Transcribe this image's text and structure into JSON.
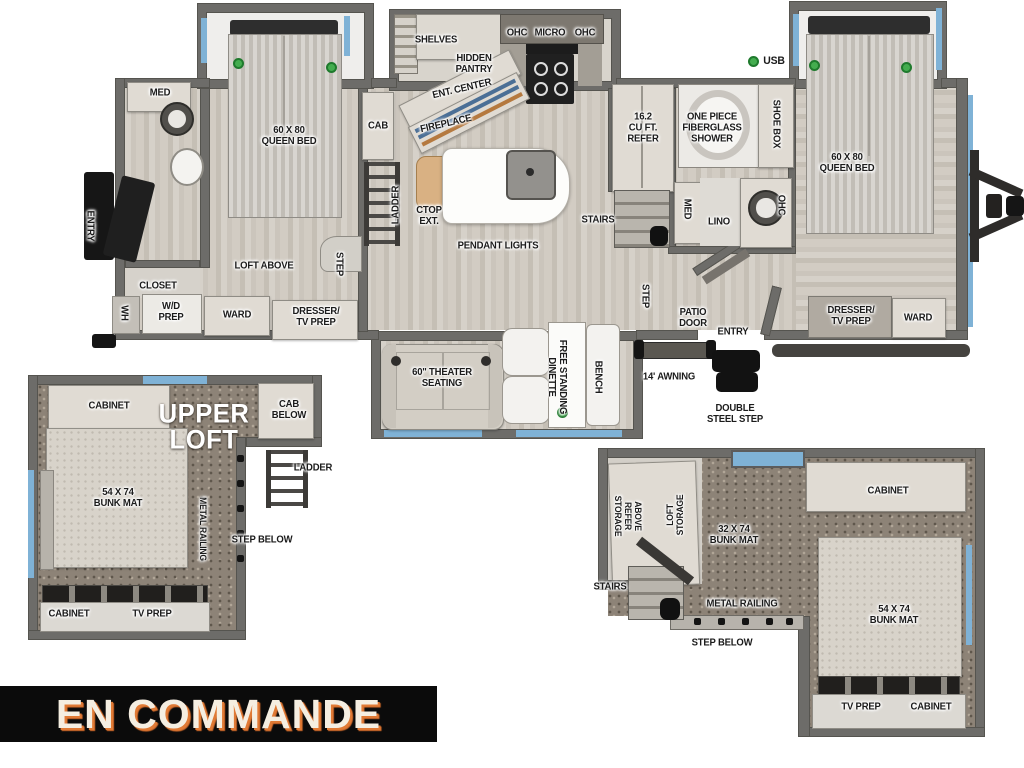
{
  "banner": {
    "label": "EN COMMANDE"
  },
  "colors": {
    "wall": "#6d6c69",
    "floor_light": "#d6d1c9",
    "floor_dark": "#c5bfb5",
    "carpet": "#8d8377",
    "furniture": "#e0dbd3",
    "accent_blue": "#7fb2d6",
    "indicator_green": "#44ad4f",
    "banner_bg": "#0b0b0b",
    "banner_text": "#f5eee1",
    "banner_shadow": "#e07a35"
  },
  "regions": {
    "main_floorplan": {
      "name": "main-floorplan",
      "labels": [
        {
          "t": "MED",
          "x": 160,
          "y": 93
        },
        {
          "t": "ENTRY",
          "x": 90,
          "y": 226,
          "r": 90
        },
        {
          "t": "CLOSET",
          "x": 158,
          "y": 286
        },
        {
          "t": "WH",
          "x": 124,
          "y": 313,
          "r": 90
        },
        {
          "t": "W/D\nPREP",
          "x": 171,
          "y": 312
        },
        {
          "t": "60 X 80\nQUEEN BED",
          "x": 289,
          "y": 136
        },
        {
          "t": "LOFT ABOVE",
          "x": 264,
          "y": 266
        },
        {
          "t": "WARD",
          "x": 237,
          "y": 315
        },
        {
          "t": "DRESSER/\nTV PREP",
          "x": 316,
          "y": 317
        },
        {
          "t": "STEP",
          "x": 339,
          "y": 264,
          "r": 90
        },
        {
          "t": "CAB",
          "x": 378,
          "y": 126
        },
        {
          "t": "LADDER",
          "x": 396,
          "y": 205,
          "r": -90
        },
        {
          "t": "SHELVES",
          "x": 436,
          "y": 40
        },
        {
          "t": "HIDDEN\nPANTRY",
          "x": 474,
          "y": 64
        },
        {
          "t": "ENT. CENTER",
          "x": 462,
          "y": 89,
          "r": -13
        },
        {
          "t": "FIREPLACE",
          "x": 446,
          "y": 124,
          "r": -13
        },
        {
          "t": "OHC",
          "x": 517,
          "y": 33
        },
        {
          "t": "MICRO",
          "x": 550,
          "y": 33
        },
        {
          "t": "OHC",
          "x": 585,
          "y": 33
        },
        {
          "t": "CTOP\nEXT.",
          "x": 429,
          "y": 216
        },
        {
          "t": "PENDANT LIGHTS",
          "x": 498,
          "y": 246
        },
        {
          "t": "STAIRS",
          "x": 598,
          "y": 220
        },
        {
          "t": "16.2\nCU FT.\nREFER",
          "x": 643,
          "y": 128
        },
        {
          "t": "USB",
          "x": 774,
          "y": 61,
          "fs": 11
        },
        {
          "t": "ONE PIECE\nFIBERGLASS\nSHOWER",
          "x": 712,
          "y": 128
        },
        {
          "t": "SHOE BOX",
          "x": 776,
          "y": 124,
          "r": 90
        },
        {
          "t": "MED",
          "x": 687,
          "y": 209,
          "r": 90
        },
        {
          "t": "LINO",
          "x": 719,
          "y": 222
        },
        {
          "t": "OHC",
          "x": 781,
          "y": 205,
          "r": 90
        },
        {
          "t": "STEP",
          "x": 645,
          "y": 296,
          "r": 90
        },
        {
          "t": "PATIO\nDOOR",
          "x": 693,
          "y": 318
        },
        {
          "t": "ENTRY",
          "x": 733,
          "y": 332
        },
        {
          "t": "60 X 80\nQUEEN BED",
          "x": 847,
          "y": 163
        },
        {
          "t": "DRESSER/\nTV PREP",
          "x": 851,
          "y": 316
        },
        {
          "t": "WARD",
          "x": 918,
          "y": 318
        },
        {
          "t": "60\" THEATER\nSEATING",
          "x": 442,
          "y": 378
        },
        {
          "t": "FREE STANDING\nDINETTE",
          "x": 557,
          "y": 377,
          "r": 90
        },
        {
          "t": "BENCH",
          "x": 598,
          "y": 377,
          "r": 90
        },
        {
          "t": "14' AWNING",
          "x": 669,
          "y": 377
        },
        {
          "t": "DOUBLE\nSTEEL STEP",
          "x": 735,
          "y": 414
        }
      ]
    },
    "upper_loft_left": {
      "name": "upper-loft-left",
      "labels": [
        {
          "t": "CABINET",
          "x": 109,
          "y": 406
        },
        {
          "t": "UPPER\nLOFT",
          "x": 204,
          "y": 427,
          "fs": 27,
          "c": "white"
        },
        {
          "t": "CAB\nBELOW",
          "x": 289,
          "y": 410
        },
        {
          "t": "LADDER",
          "x": 313,
          "y": 468
        },
        {
          "t": "54 X 74\nBUNK MAT",
          "x": 118,
          "y": 498
        },
        {
          "t": "METAL RAILING",
          "x": 202,
          "y": 529,
          "r": 90,
          "fs": 9
        },
        {
          "t": "STEP BELOW",
          "x": 262,
          "y": 540
        },
        {
          "t": "CABINET",
          "x": 69,
          "y": 614
        },
        {
          "t": "TV PREP",
          "x": 152,
          "y": 614
        }
      ]
    },
    "upper_loft_right": {
      "name": "upper-loft-right",
      "labels": [
        {
          "t": "ABOVE\nREFER\nSTORAGE",
          "x": 627,
          "y": 516,
          "r": 90,
          "fs": 9
        },
        {
          "t": "LOFT\nSTORAGE",
          "x": 676,
          "y": 515,
          "r": -90,
          "fs": 9
        },
        {
          "t": "32 X 74\nBUNK MAT",
          "x": 734,
          "y": 535
        },
        {
          "t": "CABINET",
          "x": 888,
          "y": 491
        },
        {
          "t": "STAIRS",
          "x": 610,
          "y": 587
        },
        {
          "t": "METAL RAILING",
          "x": 742,
          "y": 604
        },
        {
          "t": "STEP BELOW",
          "x": 722,
          "y": 643
        },
        {
          "t": "54 X 74\nBUNK MAT",
          "x": 894,
          "y": 615
        },
        {
          "t": "TV PREP",
          "x": 861,
          "y": 707
        },
        {
          "t": "CABINET",
          "x": 931,
          "y": 707
        }
      ]
    }
  }
}
